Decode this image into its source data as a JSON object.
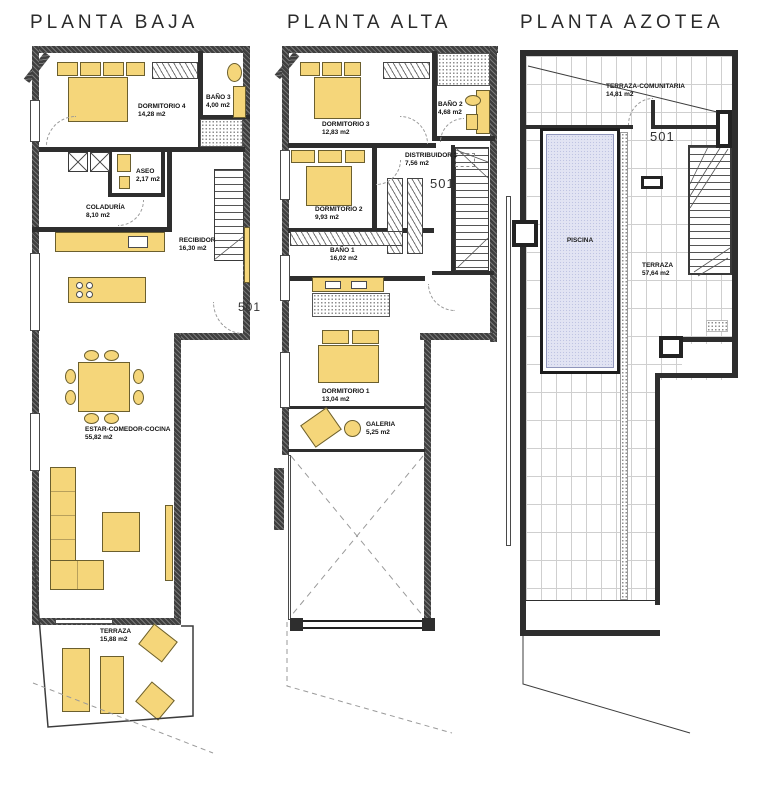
{
  "palette": {
    "furniture_yellow": "#f5d67a",
    "pool_blue": "#e2e4f3",
    "wall_dark": "#3f3f3f",
    "tile_line": "#cfcfcf"
  },
  "plans": {
    "baja": {
      "title": "PLANTA BAJA",
      "unit_tag": "501",
      "rooms": {
        "dormitorio4": {
          "name": "DORMITORIO 4",
          "area": "14,28 m2"
        },
        "bano3": {
          "name": "BAÑO 3",
          "area": "4,00 m2"
        },
        "aseo": {
          "name": "ASEO",
          "area": "2,17 m2"
        },
        "coladuria": {
          "name": "COLADURÍA",
          "area": "8,10 m2"
        },
        "recibidor": {
          "name": "RECIBIDOR",
          "area": "16,30 m2"
        },
        "estar": {
          "name": "ESTAR-COMEDOR-COCINA",
          "area": "55,82 m2"
        },
        "terraza": {
          "name": "TERRAZA",
          "area": "15,88 m2"
        }
      }
    },
    "alta": {
      "title": "PLANTA ALTA",
      "unit_tag": "501",
      "rooms": {
        "dormitorio3": {
          "name": "DORMITORIO 3",
          "area": "12,83 m2"
        },
        "bano2": {
          "name": "BAÑO 2",
          "area": "4,68 m2"
        },
        "distribuidor1": {
          "name": "DISTRIBUIDOR 1",
          "area": "7,56 m2"
        },
        "dormitorio2": {
          "name": "DORMITORIO 2",
          "area": "9,93 m2"
        },
        "bano1": {
          "name": "BAÑO 1",
          "area": "16,02 m2"
        },
        "dormitorio1": {
          "name": "DORMITORIO 1",
          "area": "13,04 m2"
        },
        "galeria": {
          "name": "GALERIA",
          "area": "5,25 m2"
        }
      }
    },
    "azotea": {
      "title": "PLANTA AZOTEA",
      "unit_tag": "501",
      "rooms": {
        "terraza_comunitaria": {
          "name": "TERRAZA-COMUNITARIA",
          "area": "14,81 m2"
        },
        "piscina": {
          "name": "PISCINA"
        },
        "terraza": {
          "name": "TERRAZA",
          "area": "57,64 m2"
        }
      }
    }
  }
}
